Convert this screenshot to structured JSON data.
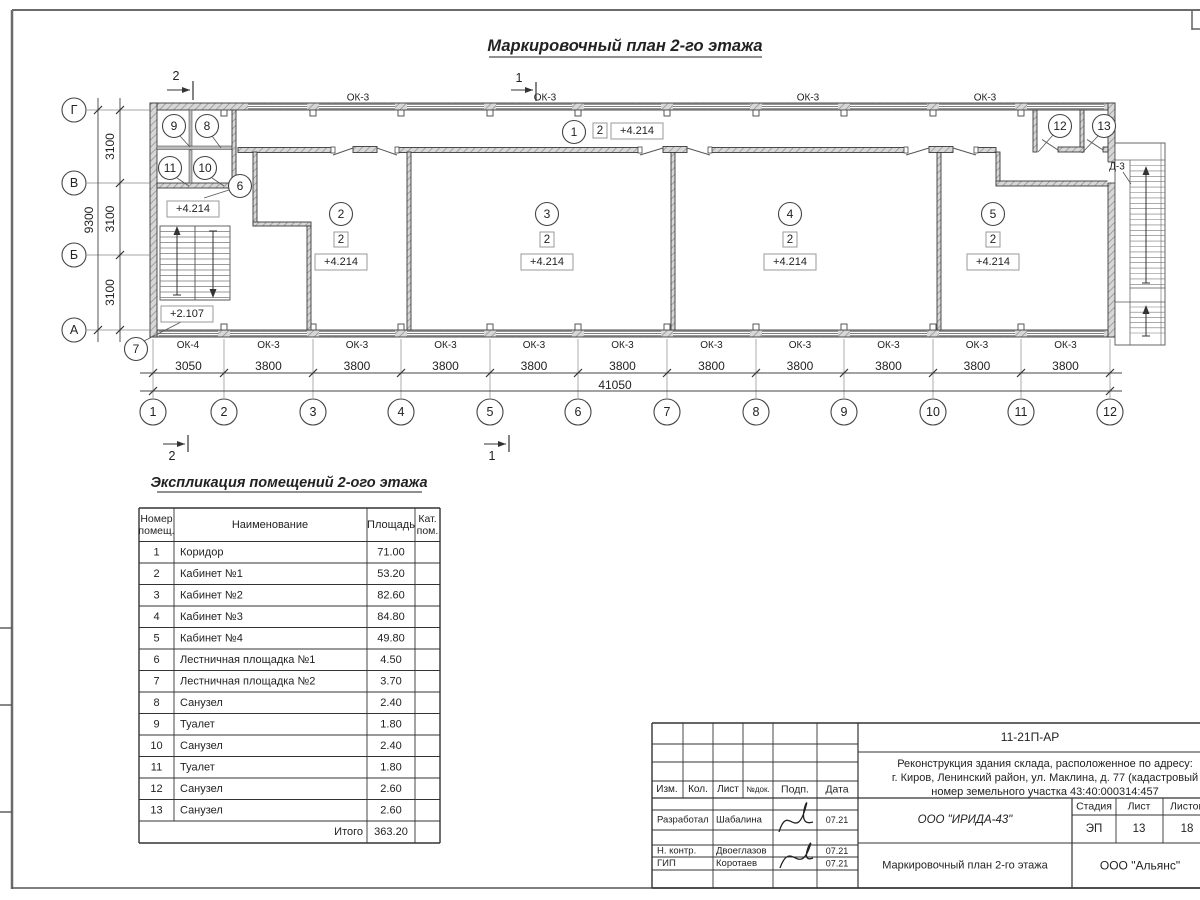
{
  "sheet": {
    "title": "Маркировочный план 2-го этажа"
  },
  "plan": {
    "section_marks": [
      "1",
      "2"
    ],
    "axes_bottom": [
      "1",
      "2",
      "3",
      "4",
      "5",
      "6",
      "7",
      "8",
      "9",
      "10",
      "11",
      "12"
    ],
    "axes_left": [
      "Г",
      "В",
      "Б",
      "А"
    ],
    "dim_first": "3050",
    "dim_typical": "3800",
    "dim_total": "41050",
    "dim_left_typical": "3100",
    "dim_left_total": "9300",
    "window_mark_first": "ОК-4",
    "window_mark_typical": "ОК-3",
    "door_mark": "Д-3",
    "room_circles": [
      "1",
      "2",
      "3",
      "4",
      "5",
      "6",
      "7",
      "8",
      "9",
      "10",
      "11",
      "12",
      "13"
    ],
    "category_value": "2",
    "elevation_main": "+4.214",
    "elevation_stair": "+2.107"
  },
  "schedule": {
    "title": "Экспликация помещений 2-ого этажа",
    "col_headers": [
      [
        "Номер",
        "помещ."
      ],
      [
        "Наименование"
      ],
      [
        "Площадь"
      ],
      [
        "Кат.",
        "пом."
      ]
    ],
    "rows": [
      {
        "n": "1",
        "name": "Коридор",
        "area": "71.00"
      },
      {
        "n": "2",
        "name": "Кабинет №1",
        "area": "53.20"
      },
      {
        "n": "3",
        "name": "Кабинет №2",
        "area": "82.60"
      },
      {
        "n": "4",
        "name": "Кабинет №3",
        "area": "84.80"
      },
      {
        "n": "5",
        "name": "Кабинет №4",
        "area": "49.80"
      },
      {
        "n": "6",
        "name": "Лестничная площадка №1",
        "area": "4.50"
      },
      {
        "n": "7",
        "name": "Лестничная площадка №2",
        "area": "3.70"
      },
      {
        "n": "8",
        "name": "Санузел",
        "area": "2.40"
      },
      {
        "n": "9",
        "name": "Туалет",
        "area": "1.80"
      },
      {
        "n": "10",
        "name": "Санузел",
        "area": "2.40"
      },
      {
        "n": "11",
        "name": "Туалет",
        "area": "1.80"
      },
      {
        "n": "12",
        "name": "Санузел",
        "area": "2.60"
      },
      {
        "n": "13",
        "name": "Санузел",
        "area": "2.60"
      }
    ],
    "total_label": "Итого",
    "total_value": "363.20"
  },
  "titleblock": {
    "doc_code": "11-21П-АР",
    "project_line1": "Реконструкция здания склада, расположенное по адресу:",
    "project_line2": "г. Киров, Ленинский район, ул. Маклина, д. 77 (кадастровый",
    "project_line3": "номер земельного участка 43:40:000314:457",
    "rev_headers": [
      "Изм.",
      "Кол.",
      "Лист",
      "№док.",
      "Подп.",
      "Дата"
    ],
    "people": [
      {
        "role": "Разработал",
        "name": "Шабалина",
        "date": "07.21"
      },
      {
        "role": "Н. контр.",
        "name": "Двоеглазов",
        "date": "07.21"
      },
      {
        "role": "ГИП",
        "name": "Коротаев",
        "date": "07.21"
      }
    ],
    "designer_org": "ООО \"ИРИДА-43\"",
    "drawing_title": "Маркировочный план 2-го этажа",
    "stage_headers": [
      "Стадия",
      "Лист",
      "Листов"
    ],
    "stage": "ЭП",
    "sheet_num": "13",
    "sheet_total": "18",
    "customer_org": "ООО \"Альянс\""
  }
}
